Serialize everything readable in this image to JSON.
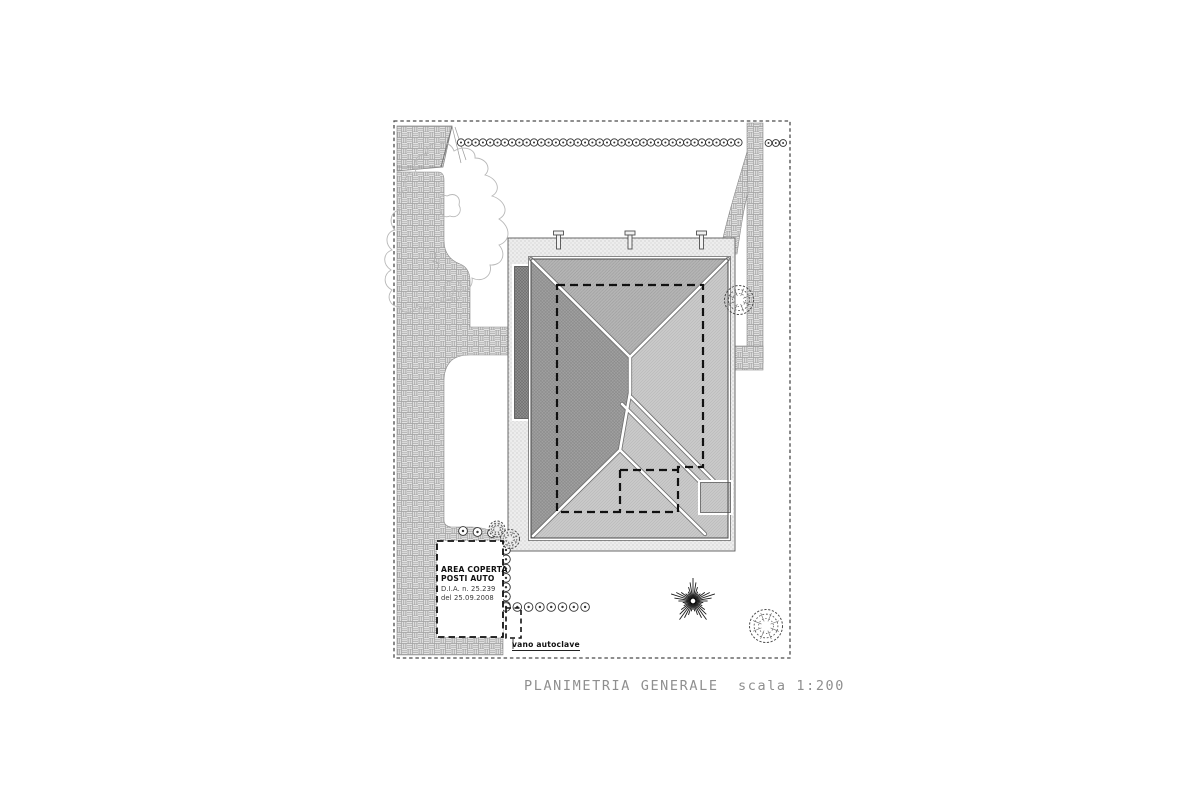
{
  "plan": {
    "title": "PLANIMETRIA GENERALE  scala 1:200",
    "area_coperta_box": {
      "line1": "AREA COPERTA",
      "line2": "POSTI AUTO",
      "line3": "D.I.A. n. 25.239",
      "line4": "del 25.09.2008"
    },
    "autoclave_label": "vano autoclave"
  },
  "symbols": {
    "hedge_plant": "hedge-plant-circle-icon",
    "palm_tree": "palm-tree-icon",
    "round_bush": "round-bush-icon"
  },
  "colors": {
    "paving": "#e2e2e2",
    "terrace": "#ededed",
    "roof_dark": "#a2a2a2",
    "roof_medium": "#b5b5b5",
    "roof_light": "#c9c9c9",
    "side_roof_dark": "#8e8e8e",
    "line_dark": "#444444",
    "title_text": "#8f8f8f"
  }
}
